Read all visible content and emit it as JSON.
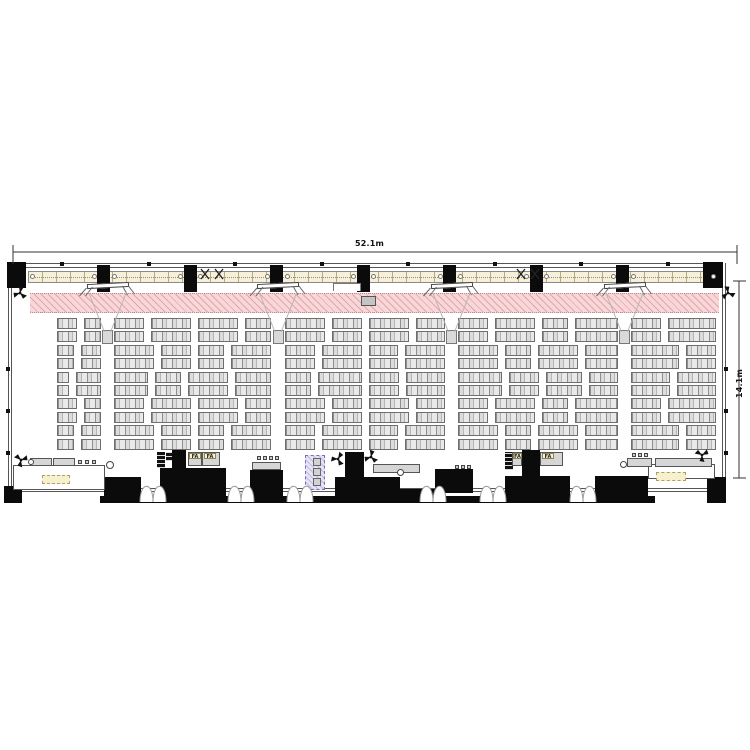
{
  "drawing": {
    "kind": "conference-hall floor plan, plan view",
    "canvas": {
      "w": 750,
      "h": 750,
      "background": "#ffffff"
    }
  },
  "dimensions": {
    "width_label": "52.1m",
    "height_label": "14.1m",
    "h_line": {
      "x1": 13,
      "x2": 737,
      "y": 252
    },
    "v_line": {
      "x": 739,
      "y1": 281,
      "y2": 478
    }
  },
  "labels": {
    "fa": "FA"
  },
  "colors": {
    "wall": "#555555",
    "black_equipment": "#0b0b0b",
    "stage_pink": "#f8d7d9",
    "stage_hatch": "#d27d87",
    "truss_cream": "#f6f0d8",
    "seat_gray": "#dcdcdc",
    "booth_lavender": "#e7e3f5",
    "label_cream": "#f7f0cf",
    "cone_gray": "#b5b5b5",
    "dim_text": "#111111"
  },
  "hall": {
    "left": 8,
    "right": 726,
    "top": 263,
    "bottom_line": 488,
    "bottom_bar_y": 496,
    "wall_clip_ys": [
      367,
      409,
      451
    ]
  },
  "truss": {
    "band": {
      "x1": 28,
      "x2": 718,
      "y": 271,
      "h": 12
    },
    "speaker_centers": [
      17,
      103.5,
      190,
      276.5,
      363,
      449.5,
      536,
      622.5,
      709
    ],
    "speaker": {
      "w": 13,
      "h": 27,
      "y": 265
    },
    "corner_speakers": [
      {
        "x": 7,
        "y": 262,
        "w": 19,
        "h": 26
      },
      {
        "x": 703,
        "y": 262,
        "w": 20,
        "h": 26
      }
    ],
    "clip_xs": [
      60,
      147,
      233,
      320,
      406,
      493,
      579,
      666
    ],
    "x_fixture_centers": [
      212,
      528
    ]
  },
  "stage_band": {
    "x1": 30,
    "x2": 719,
    "y1": 293,
    "y2": 313
  },
  "center_box": {
    "x": 361,
    "y": 296,
    "w": 15,
    "h": 10
  },
  "bracket": {
    "x": 333,
    "y": 283,
    "w": 28,
    "h": 8
  },
  "projection": {
    "centers": [
      107.5,
      278,
      451.5,
      624.5
    ],
    "screen_y": 283,
    "screen_half_w": 21,
    "cone_top_y": 292,
    "cone_half_w": 19,
    "projector": {
      "y": 330,
      "w": 11,
      "h": 14
    }
  },
  "seating": {
    "y0": 318,
    "pitch": 13.4,
    "rows": 10,
    "seat_h": 11,
    "gap": 7,
    "regions": [
      [
        57,
        101
      ],
      [
        114,
        271
      ],
      [
        285,
        445
      ],
      [
        458,
        618
      ],
      [
        631,
        716
      ]
    ],
    "variants": [
      [
        [
          20,
          17
        ],
        [
          30,
          40,
          40,
          26
        ],
        [
          40,
          30,
          40,
          29
        ],
        [
          30,
          40,
          26,
          43
        ],
        [
          30,
          48
        ]
      ],
      [
        [
          17,
          20
        ],
        [
          40,
          30,
          26,
          40
        ],
        [
          30,
          40,
          29,
          40
        ],
        [
          40,
          26,
          40,
          33
        ],
        [
          48,
          30
        ]
      ],
      [
        [
          12,
          25
        ],
        [
          34,
          26,
          40,
          36
        ],
        [
          26,
          44,
          30,
          39
        ],
        [
          44,
          30,
          36,
          29
        ],
        [
          39,
          39
        ]
      ]
    ]
  },
  "equipment": {
    "black_blocks": [
      {
        "x": 4,
        "y": 486,
        "w": 18,
        "h": 17
      },
      {
        "x": 104,
        "y": 477,
        "w": 37,
        "h": 26
      },
      {
        "x": 172,
        "y": 450,
        "w": 14,
        "h": 26
      },
      {
        "x": 160,
        "y": 468,
        "w": 66,
        "h": 34
      },
      {
        "x": 250,
        "y": 470,
        "w": 33,
        "h": 32
      },
      {
        "x": 345,
        "y": 452,
        "w": 19,
        "h": 26
      },
      {
        "x": 335,
        "y": 477,
        "w": 65,
        "h": 26
      },
      {
        "x": 400,
        "y": 489,
        "w": 35,
        "h": 14
      },
      {
        "x": 435,
        "y": 469,
        "w": 38,
        "h": 24
      },
      {
        "x": 522,
        "y": 450,
        "w": 18,
        "h": 26
      },
      {
        "x": 505,
        "y": 476,
        "w": 65,
        "h": 26
      },
      {
        "x": 595,
        "y": 476,
        "w": 53,
        "h": 27
      },
      {
        "x": 100,
        "y": 496,
        "w": 555,
        "h": 7
      },
      {
        "x": 707,
        "y": 477,
        "w": 19,
        "h": 26
      }
    ],
    "racks": [
      {
        "x": 157,
        "y": 452,
        "w": 8,
        "h": 16
      },
      {
        "x": 166,
        "y": 452,
        "w": 6,
        "h": 9
      },
      {
        "x": 505,
        "y": 452,
        "w": 8,
        "h": 18
      }
    ],
    "tables": [
      {
        "x": 30,
        "y": 458,
        "w": 22,
        "h": 8
      },
      {
        "x": 53,
        "y": 458,
        "w": 22,
        "h": 8
      },
      {
        "x": 252,
        "y": 462,
        "w": 29,
        "h": 8
      },
      {
        "x": 373,
        "y": 464,
        "w": 47,
        "h": 9
      },
      {
        "x": 627,
        "y": 458,
        "w": 25,
        "h": 9
      },
      {
        "x": 655,
        "y": 458,
        "w": 57,
        "h": 9
      }
    ],
    "open_rects": [
      {
        "x": 13,
        "y": 465,
        "w": 92,
        "h": 25
      },
      {
        "x": 648,
        "y": 464,
        "w": 67,
        "h": 15
      }
    ],
    "desks": [
      {
        "x": 188,
        "y": 452,
        "w": 14,
        "h": 14
      },
      {
        "x": 202,
        "y": 452,
        "w": 18,
        "h": 14
      },
      {
        "x": 512,
        "y": 452,
        "w": 10,
        "h": 14
      },
      {
        "x": 540,
        "y": 452,
        "w": 23,
        "h": 14
      }
    ],
    "fa_chips": [
      {
        "x": 189,
        "y": 453,
        "w": 12,
        "h": 6
      },
      {
        "x": 204,
        "y": 453,
        "w": 12,
        "h": 6
      },
      {
        "x": 513,
        "y": 453,
        "w": 9,
        "h": 6
      },
      {
        "x": 542,
        "y": 453,
        "w": 12,
        "h": 6
      }
    ],
    "cream_labels": [
      {
        "x": 42,
        "y": 475,
        "w": 28,
        "h": 9
      },
      {
        "x": 656,
        "y": 472,
        "w": 30,
        "h": 9
      }
    ],
    "booth": {
      "x": 305,
      "y": 455,
      "w": 20,
      "h": 35,
      "squares": [
        {
          "x": 313,
          "y": 458,
          "w": 8,
          "h": 8
        },
        {
          "x": 313,
          "y": 468,
          "w": 8,
          "h": 8
        },
        {
          "x": 313,
          "y": 478,
          "w": 8,
          "h": 8
        }
      ]
    },
    "stool_groups": [
      {
        "x": 78,
        "y": 460,
        "n": 3,
        "step": 7
      },
      {
        "x": 257,
        "y": 456,
        "n": 4,
        "step": 6
      },
      {
        "x": 455,
        "y": 465,
        "n": 3,
        "step": 6
      },
      {
        "x": 632,
        "y": 453,
        "n": 3,
        "step": 6
      }
    ],
    "circles": [
      {
        "cx": 110,
        "cy": 465,
        "d": 8
      },
      {
        "cx": 400,
        "cy": 472,
        "d": 7
      },
      {
        "cx": 623,
        "cy": 464,
        "d": 7
      },
      {
        "cx": 31,
        "cy": 462,
        "d": 6
      }
    ],
    "arc_pairs_x": [
      140,
      228,
      287,
      420,
      480,
      570
    ],
    "arc_y": 479,
    "fans": [
      {
        "x": 20,
        "y": 293,
        "rot": 40
      },
      {
        "x": 728,
        "y": 293,
        "rot": 140
      },
      {
        "x": 21,
        "y": 460,
        "rot": -20
      },
      {
        "x": 702,
        "y": 455,
        "rot": 210
      },
      {
        "x": 338,
        "y": 459,
        "rot": 180
      },
      {
        "x": 371,
        "y": 457,
        "rot": 160
      }
    ]
  }
}
